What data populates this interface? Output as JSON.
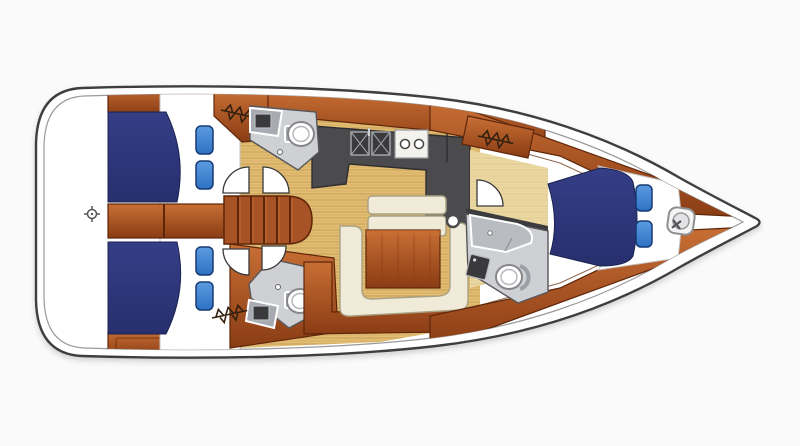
{
  "meta": {
    "title": "Sailing yacht interior layout plan",
    "orientation": "bow to the right, stern to the left, top-down view"
  },
  "colors": {
    "background": "#fafafa",
    "deck": "#ffffff",
    "hull-line": "#3e3e40",
    "hull-inner-line": "#9a9a9c",
    "navy": "#272f6e",
    "navy-light": "#353e86",
    "cushion": "#2f72c4",
    "cushion-light": "#5b9be0",
    "cushion-dark": "#173a74",
    "wood": "#e3bd72",
    "wood-pale": "#ecd9a2",
    "mahogany": "#b05521",
    "mahogany-light": "#c86f35",
    "mahogany-dark": "#8a3c14",
    "mahogany-line": "#5e2609",
    "counter": "#4b4b4d",
    "counter-dark": "#2e2e30",
    "head-floor": "#ced0d4",
    "fixture": "#a7abb1",
    "fixture-dark": "#3a3a3c",
    "porcelain": "#ffffff",
    "cream": "#f0ebd8",
    "cream-line": "#a9a184"
  },
  "summary": {
    "cabins": 3,
    "heads": 3,
    "berth_cushions": 6,
    "galley": "double sink and two-burner stove",
    "salon": "U-shaped settee with wooden table",
    "companionway_steps": 5
  },
  "icons": [
    {
      "name": "helm-compass-icon"
    },
    {
      "name": "hanging-locker-icon"
    },
    {
      "name": "windlass-icon"
    },
    {
      "name": "galley-sink-icon"
    },
    {
      "name": "stove-burner-icon"
    },
    {
      "name": "toilet-icon"
    },
    {
      "name": "mast-post-icon"
    }
  ]
}
